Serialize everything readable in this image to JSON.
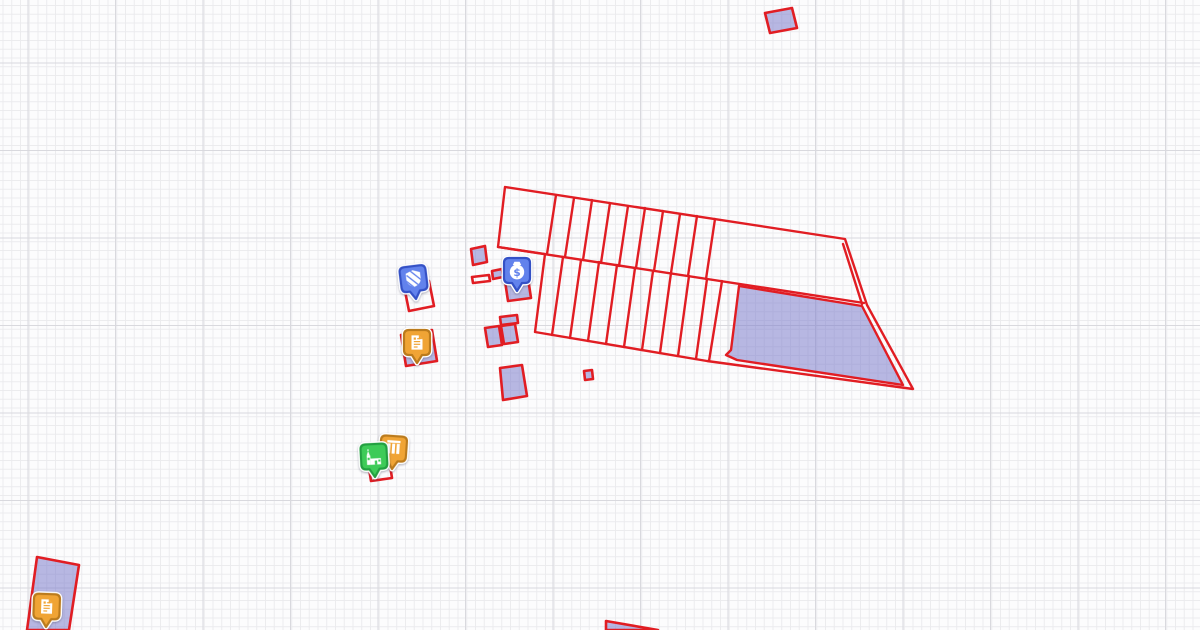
{
  "app": {
    "kind": "cadastral-map-canvas",
    "visible_text": []
  },
  "canvas": {
    "width": 1200,
    "height": 630,
    "background": "#fcfcfd",
    "grid": {
      "minor_spacing": 8.75,
      "major_spacing": 87.5,
      "minor_color": "#ebebee",
      "major_color": "#d9d9de",
      "offset_x": 27.5,
      "offset_y": 62.5
    }
  },
  "palette": {
    "outline_red": "#e11d23",
    "parcel_fill": "rgba(126,126,204,0.55)",
    "pin_blue": "#6282ec",
    "pin_blue_border": "#3451c6",
    "pin_orange": "#f0a435",
    "pin_orange_border": "#bb7b1d",
    "pin_green": "#3ecb58",
    "pin_green_border": "#23a041",
    "icon_white": "#ffffff",
    "pin_halo": "#ffffff"
  },
  "structure": {
    "name": "field-strip-block",
    "boundary": "505,187 845,239 867,305 913,389 707,361 535,332 545,254 498,247",
    "middle_line": [
      498,
      247,
      864,
      303
    ],
    "inner_edge": [
      843,
      244,
      862,
      304
    ],
    "upper_rungs": [
      [
        556,
        195,
        547,
        254
      ],
      [
        574,
        198,
        565,
        257
      ],
      [
        592,
        200,
        583,
        260
      ],
      [
        610,
        203,
        601,
        263
      ],
      [
        628,
        206,
        619,
        266
      ],
      [
        645,
        208,
        636,
        268
      ],
      [
        663,
        211,
        654,
        271
      ],
      [
        680,
        214,
        671,
        273
      ],
      [
        697,
        216,
        688,
        276
      ],
      [
        715,
        219,
        706,
        279
      ]
    ],
    "lower_rungs": [
      [
        563,
        257,
        552,
        335
      ],
      [
        581,
        260,
        570,
        338
      ],
      [
        599,
        262,
        588,
        341
      ],
      [
        617,
        265,
        606,
        344
      ],
      [
        635,
        268,
        624,
        347
      ],
      [
        653,
        271,
        642,
        350
      ],
      [
        671,
        273,
        660,
        353
      ],
      [
        689,
        276,
        678,
        356
      ],
      [
        707,
        279,
        696,
        359
      ],
      [
        722,
        281,
        709,
        361
      ]
    ],
    "infill_parcel": "739,286 862,306 903,385 737,360 726,355 731,350"
  },
  "parcels": [
    {
      "name": "parcel-top-right",
      "points": "765,13 792,8 797,28 770,33",
      "filled": true
    },
    {
      "name": "parcel-under-shield",
      "points": "404,286 429,281 434,306 409,311",
      "filled": false
    },
    {
      "name": "parcel-small-1",
      "points": "471,249 485,246 487,262 473,265",
      "filled": true
    },
    {
      "name": "parcel-dash",
      "points": "472,277 489,275 490,281 473,283",
      "filled": false
    },
    {
      "name": "parcel-small-2",
      "points": "492,271 502,269 503,277 493,279",
      "filled": true
    },
    {
      "name": "parcel-under-money",
      "points": "505,281 528,278 531,298 508,301",
      "filled": true
    },
    {
      "name": "parcel-bar",
      "points": "500,317 517,315 518,323 501,325",
      "filled": true
    },
    {
      "name": "parcel-pair-left",
      "points": "485,328 499,326 502,345 488,347",
      "filled": true
    },
    {
      "name": "parcel-pair-right",
      "points": "501,326 515,324 518,342 504,344",
      "filled": true
    },
    {
      "name": "parcel-under-document",
      "points": "401,335 432,330 437,361 406,366",
      "filled": true
    },
    {
      "name": "parcel-small-3",
      "points": "500,368 522,365 527,396 503,400",
      "filled": true
    },
    {
      "name": "parcel-tiny-square",
      "points": "584,371 592,370 593,379 585,380",
      "filled": true
    },
    {
      "name": "parcel-under-church",
      "points": "368,462 389,459 392,478 371,481",
      "filled": false
    },
    {
      "name": "parcel-bottom-left",
      "points": "37,557 79,565 69,630 27,630",
      "filled": true
    },
    {
      "name": "parcel-bottom-wedge",
      "points": "606,621 658,630 606,630",
      "filled": true
    }
  ],
  "markers": [
    {
      "name": "marker-shield",
      "icon": "shield-icon",
      "color": "blue",
      "tip": [
        416,
        299
      ],
      "rotate": -7
    },
    {
      "name": "marker-money-bag",
      "icon": "money-bag-icon",
      "color": "blue",
      "tip": [
        517,
        291
      ],
      "rotate": 0
    },
    {
      "name": "marker-document-mid",
      "icon": "document-icon",
      "color": "orange",
      "tip": [
        417,
        363
      ],
      "rotate": 0
    },
    {
      "name": "marker-columns",
      "icon": "columns-icon",
      "color": "orange",
      "tip": [
        392,
        469
      ],
      "rotate": 4
    },
    {
      "name": "marker-church",
      "icon": "church-icon",
      "color": "green",
      "tip": [
        375,
        477
      ],
      "rotate": -3
    },
    {
      "name": "marker-document-bottom",
      "icon": "document-icon",
      "color": "orange",
      "tip": [
        46,
        627
      ],
      "rotate": 2
    }
  ],
  "money_symbol": "$"
}
